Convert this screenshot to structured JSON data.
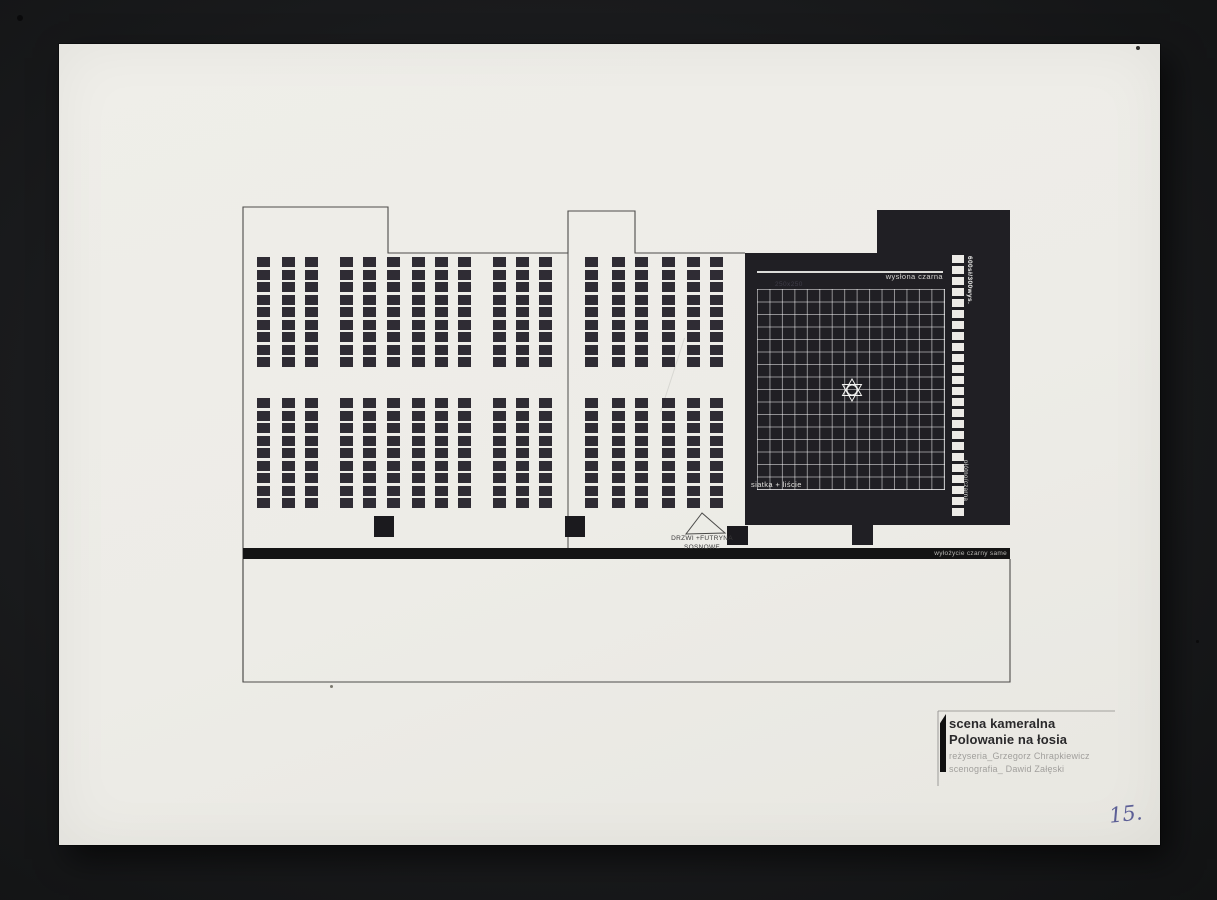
{
  "title_block": {
    "stage_label": "scena kameralna",
    "production_title": "Polowanie na łosia",
    "director_line": "reżyseria_Grzegorz Chrapkiewicz",
    "scenographer_line": "scenografia_ Dawid Załęski"
  },
  "annotations": {
    "curtain_top": "wysłona czarna",
    "grid_cell_size": "250x250",
    "side_dimension": "600sł/300wys.",
    "net_leaves": "siatka + liście",
    "side_fabric": "płótno/czarna",
    "floor_covering": "wyłożycie czarny same",
    "door_label_line1": "DRZWI +FUTRYNA",
    "door_label_line2": "SOSNOWE"
  },
  "page_number": "15.",
  "colors": {
    "paper": "#edece7",
    "stage_black": "#201f24",
    "seat_black": "#2f2c34",
    "strip_black": "#141414",
    "handwriting_ink": "#5c5f96",
    "outline": "#4d4c4a"
  },
  "plan": {
    "seating": {
      "rows_per_column": 9,
      "row_pitch": 12.5,
      "seat_w": 13,
      "seat_h": 10,
      "bands_y": [
        213,
        354
      ],
      "sections": [
        {
          "name": "left",
          "columns_x": [
            198,
            223,
            246,
            281,
            304,
            328,
            353,
            376,
            399,
            434,
            457,
            480
          ]
        },
        {
          "name": "middle",
          "columns_x": [
            526,
            553,
            576,
            603,
            628,
            651
          ]
        }
      ]
    },
    "grid": {
      "cols": 15,
      "rows": 16
    },
    "ladder_rungs": 24
  }
}
